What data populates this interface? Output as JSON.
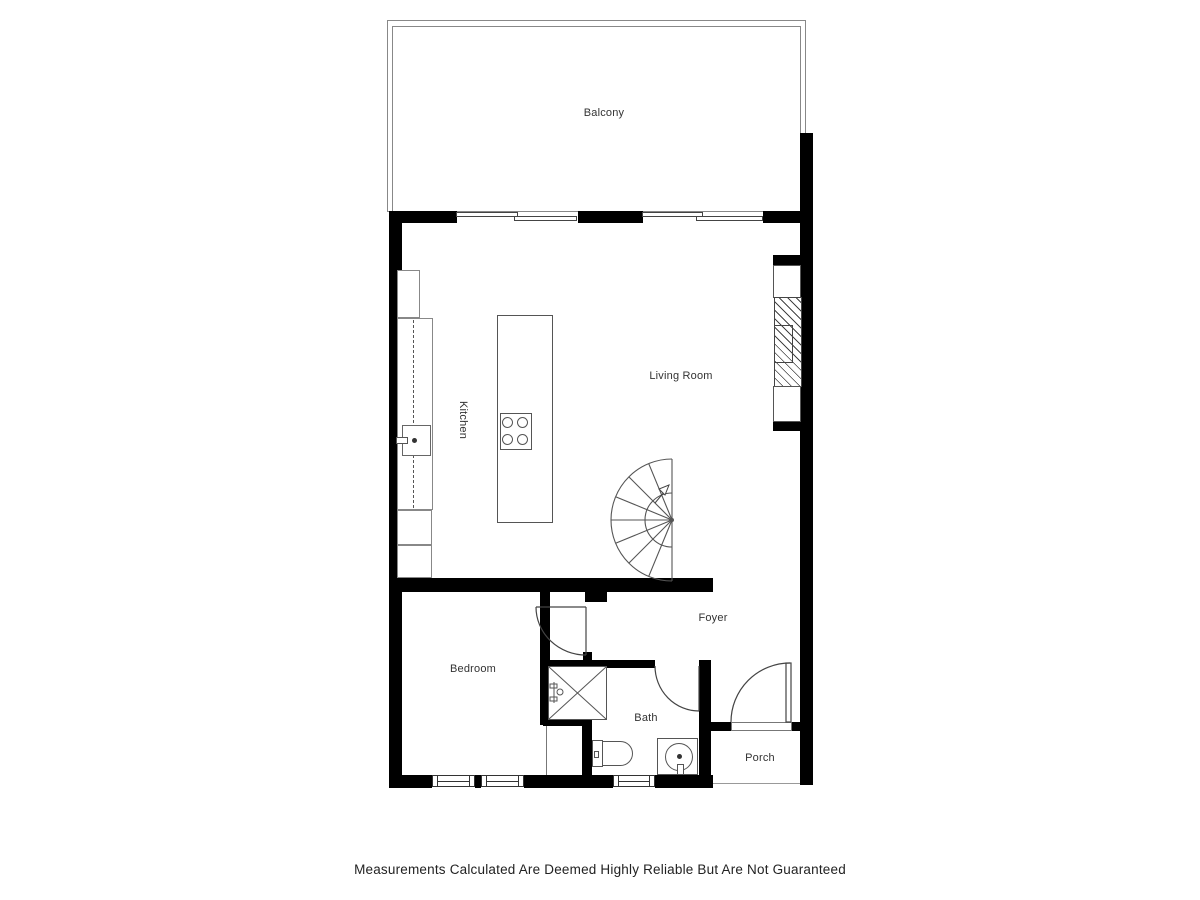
{
  "page": {
    "footer_disclaimer": "Measurements Calculated Are Deemed Highly Reliable But Are Not Guaranteed"
  },
  "floor_plan": {
    "rooms": [
      {
        "id": "balcony",
        "label": "Balcony"
      },
      {
        "id": "living-room",
        "label": "Living Room"
      },
      {
        "id": "kitchen",
        "label": "Kitchen"
      },
      {
        "id": "foyer",
        "label": "Foyer"
      },
      {
        "id": "bedroom",
        "label": "Bedroom"
      },
      {
        "id": "bath",
        "label": "Bath"
      },
      {
        "id": "porch",
        "label": "Porch"
      }
    ],
    "fixtures": [
      "refrigerator",
      "kitchen-counter",
      "kitchen-sink",
      "kitchen-island",
      "stove",
      "fireplace",
      "spiral-staircase",
      "shower",
      "closet",
      "toilet",
      "bathroom-vanity-sink"
    ],
    "colors": {
      "wall": "#000000",
      "fixture_outline": "#666666",
      "balcony_outline": "#888888",
      "label_text": "#333333"
    }
  }
}
